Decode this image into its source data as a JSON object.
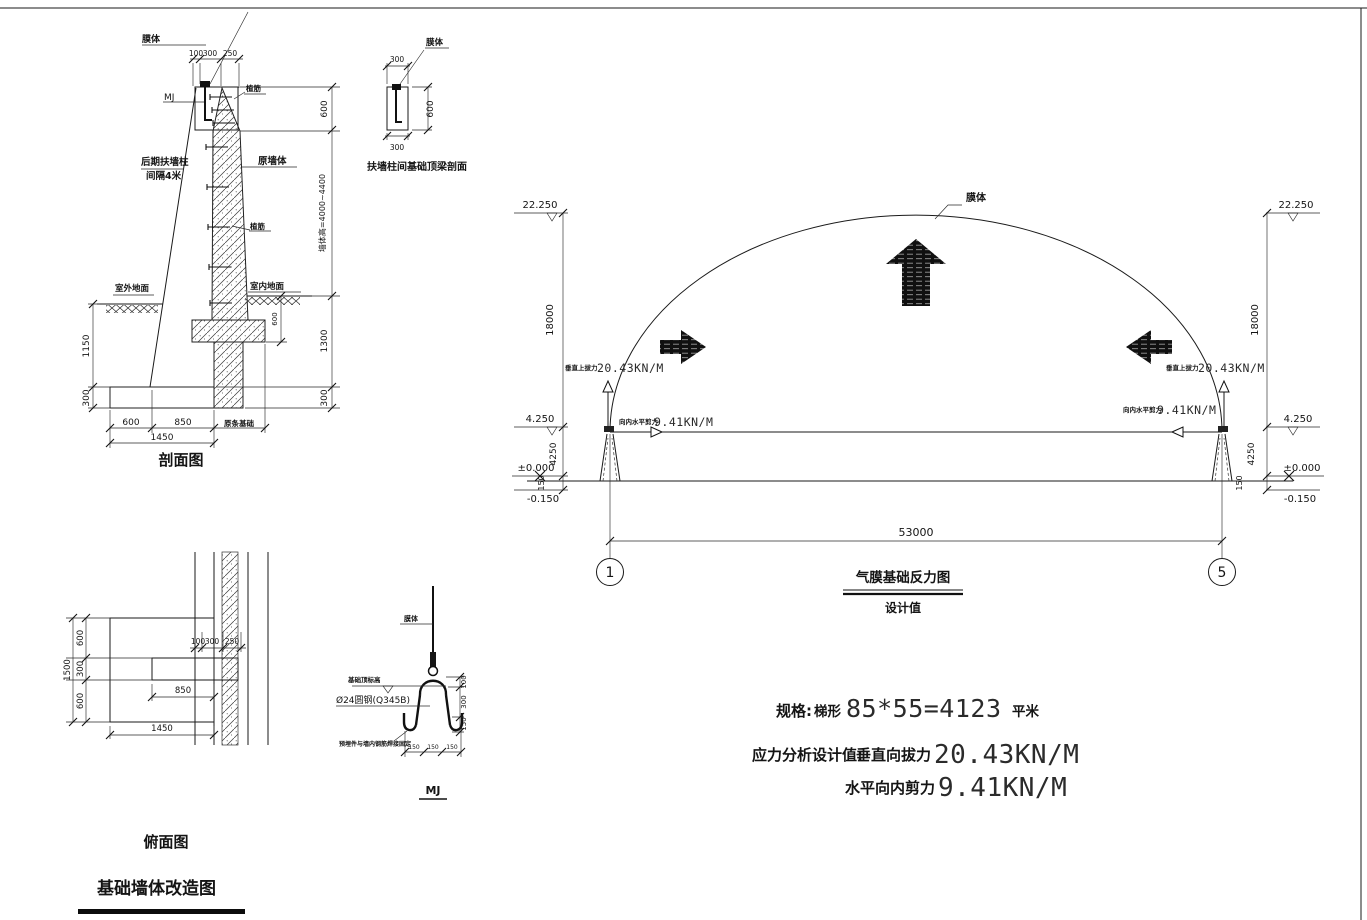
{
  "drawing": {
    "section": {
      "title": "剖面图",
      "membrane": "膜体",
      "mj": "MJ",
      "rebar": "植筋",
      "buttress1": "后期扶墙柱",
      "buttress2": "间隔4米",
      "original_wall": "原墙体",
      "outdoor_ground": "室外地面",
      "indoor_ground": "室内地面",
      "original_footing": "原条基础",
      "dims": {
        "t100": "100",
        "t300": "300",
        "t250": "250",
        "r600": "600",
        "wall_height": "墙体高=4000~4400",
        "r1300": "1300",
        "r300": "300",
        "l1150": "1150",
        "l300": "300",
        "b600": "600",
        "b850": "850",
        "b1450": "1450",
        "depth": "600"
      }
    },
    "beam_detail": {
      "title": "扶墙柱间基础顶梁剖面",
      "membrane": "膜体",
      "d_top": "300",
      "d_right": "600",
      "d_bottom": "300"
    },
    "dome": {
      "membrane": "膜体",
      "lv_top": "22.250",
      "lv_base": "4.250",
      "lv_zero": "±0.000",
      "lv_neg": "-0.150",
      "d18000": "18000",
      "d4250": "4250",
      "d150": "150",
      "uplift_label": "垂直上拔力",
      "uplift_value": "20.43KN/M",
      "shear_label": "向内水平剪力",
      "shear_value": "9.41KN/M",
      "span": "53000",
      "axis_left": "1",
      "axis_right": "5",
      "caption": "气膜基础反力图",
      "subcaption": "设计值"
    },
    "plan": {
      "title": "俯面图",
      "dims": {
        "l600a": "600",
        "l300": "300",
        "l600b": "600",
        "l1500": "1500",
        "t100": "100",
        "t300": "300",
        "t250": "250",
        "m850": "850",
        "b1450": "1450"
      }
    },
    "main_title": "基础墙体改造图",
    "mj_detail": {
      "caption": "MJ",
      "membrane": "膜体",
      "top_level": "基础顶标高",
      "bar": "Ø24圆钢(Q345B)",
      "weld": "预埋件与墙内钢筋焊接固定",
      "dims": {
        "r100": "100",
        "r300": "300",
        "r150": "150",
        "b150a": "150",
        "b150b": "150",
        "b150c": "150"
      }
    },
    "specs": {
      "spec_label": "规格:",
      "spec_prefix": "梯形",
      "spec_value": "85*55=4123",
      "spec_suffix": "平米",
      "analysis_label": "应力分析设计值:",
      "uplift_name": "垂直向拔力",
      "uplift_value": "20.43KN/M",
      "shear_name": "水平向内剪力",
      "shear_value": "9.41KN/M"
    }
  }
}
